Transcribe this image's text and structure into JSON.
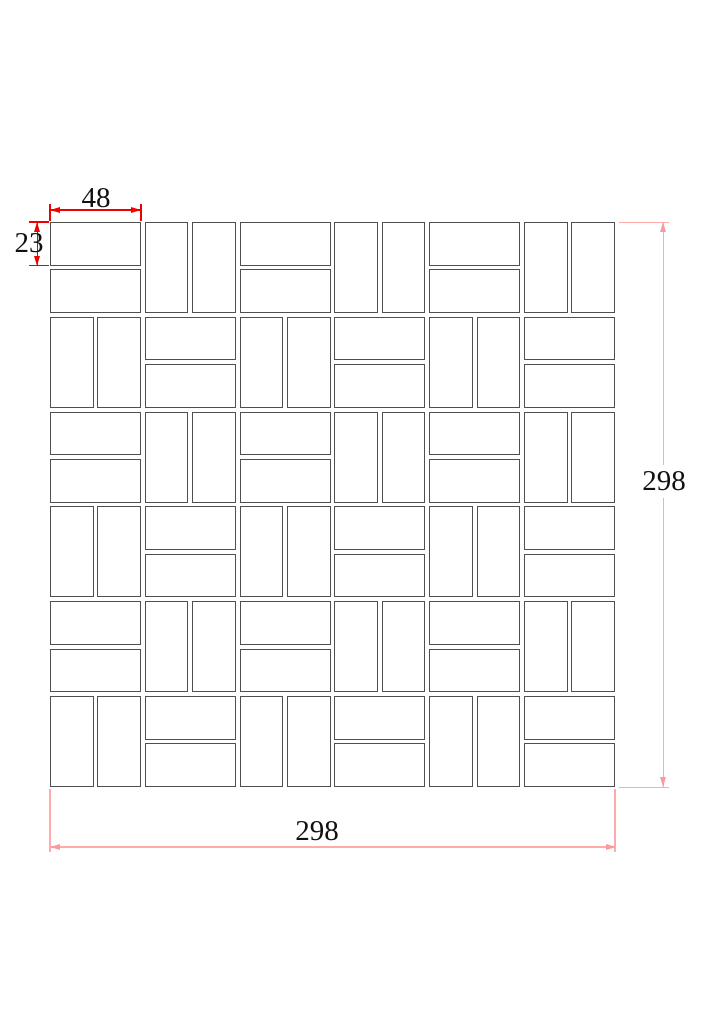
{
  "drawing": {
    "type": "tile-mosaic-sheet-technical-drawing",
    "sheet": {
      "width_mm": 298,
      "height_mm": 298,
      "chip_width_mm": 48,
      "chip_height_mm": 23,
      "joint_mm": 2,
      "blocks_per_side": 6
    },
    "pattern_rows": [
      "HVHVHV",
      "VHVHVH",
      "HVHVHV",
      "VHVHVH",
      "HVHVHV",
      "VHVHVH"
    ],
    "dimensions": {
      "chip_width": {
        "label": "48"
      },
      "chip_height": {
        "label": "23"
      },
      "sheet_height": {
        "label": "298"
      },
      "sheet_width": {
        "label": "298"
      }
    },
    "colors": {
      "background": "#ffffff",
      "tile_outline": "#4f4f4f",
      "tile_fill": "#ffffff",
      "dim_detail_red": "#f10000",
      "dim_overall_pink": "#ffabab",
      "dim_overall_arrow": "#fa9a9a",
      "label_text": "#111111"
    }
  }
}
